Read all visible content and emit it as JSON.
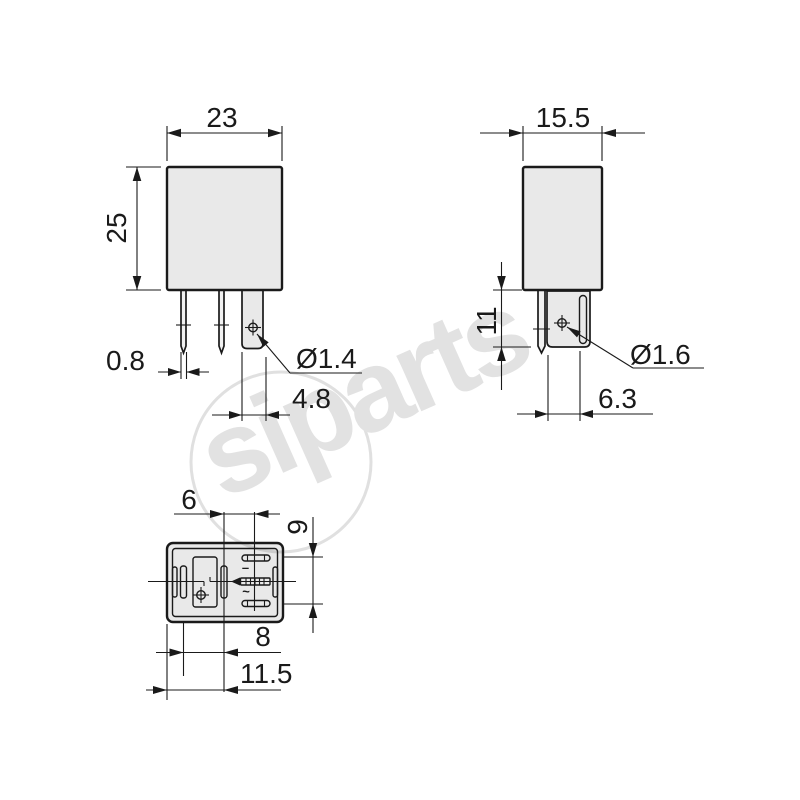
{
  "title": "relay dimensional drawing",
  "views": {
    "front": {
      "width": "23",
      "height": "25",
      "pin_width": "0.8",
      "blade_width": "4.8",
      "hole_diameter": "Ø1.4"
    },
    "side": {
      "width": "15.5",
      "terminal_length": "11",
      "hole_diameter": "Ø1.6",
      "blade_offset": "6.3"
    },
    "bottom": {
      "spacing_center": "6",
      "spacing_vertical": "9",
      "spacing_coil": "8",
      "spacing_width": "11.5",
      "minus_mark": "–",
      "ac_mark": "~"
    }
  },
  "watermark": {
    "text": "siparts"
  },
  "colors": {
    "line": "#1a1a1a",
    "body_fill": "#e8e8e8",
    "watermark": "#e2e2e2",
    "background": "#ffffff"
  }
}
